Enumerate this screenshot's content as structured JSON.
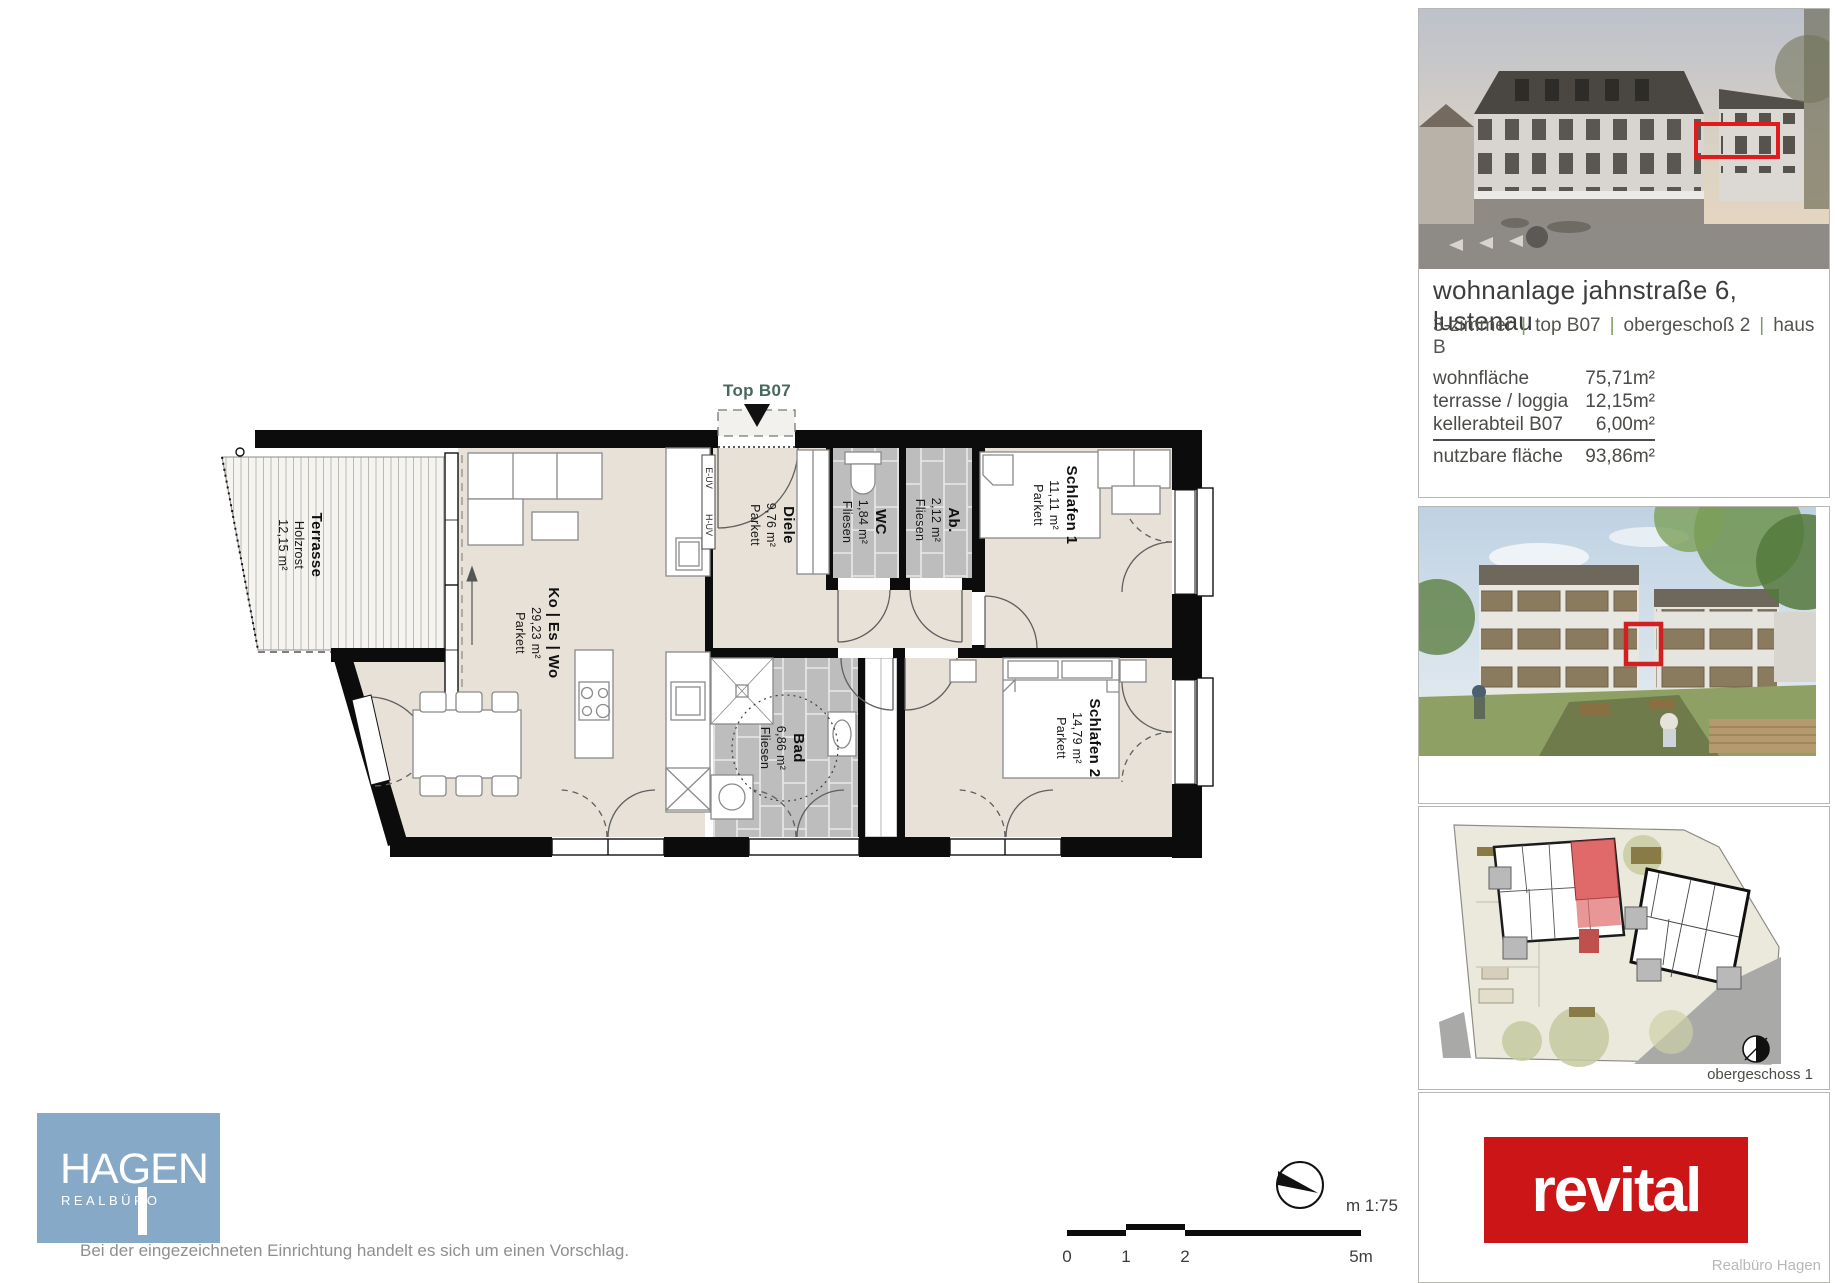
{
  "plan": {
    "top_label": "Top B07",
    "rooms": [
      {
        "id": "terrasse",
        "lines": [
          "Terrasse",
          "Holzrost",
          "12,15 m²"
        ]
      },
      {
        "id": "wohnen",
        "lines": [
          "Ko | Es | Wo",
          "29,23 m²",
          "Parkett"
        ]
      },
      {
        "id": "diele",
        "lines": [
          "Diele",
          "9,76 m²",
          "Parkett"
        ]
      },
      {
        "id": "wc",
        "lines": [
          "WC",
          "1,84 m²",
          "Fliesen"
        ]
      },
      {
        "id": "abstell",
        "lines": [
          "Ab.",
          "2,12 m²",
          "Fliesen"
        ]
      },
      {
        "id": "schlafen1",
        "lines": [
          "Schlafen 1",
          "11,11 m²",
          "Parkett"
        ]
      },
      {
        "id": "bad",
        "lines": [
          "Bad",
          "6,86 m²",
          "Fliesen"
        ]
      },
      {
        "id": "schlafen2",
        "lines": [
          "Schlafen 2",
          "14,79 m²",
          "Parkett"
        ]
      }
    ],
    "technical_labels": [
      "E-UV",
      "H-UV"
    ]
  },
  "scale": {
    "ticks": [
      "0",
      "1",
      "2",
      "5m"
    ],
    "ratio": "m 1:75"
  },
  "sidebar": {
    "title": "wohnanlage jahnstraße 6, lustenau",
    "separator": "|",
    "subtitle_parts": [
      "3-zimmer",
      "top B07",
      "obergeschoß 2",
      "haus B"
    ],
    "areas": [
      {
        "label": "wohnfläche",
        "value": "75,71m²"
      },
      {
        "label": "terrasse / loggia",
        "value": "12,15m²"
      },
      {
        "label": "kellerabteil B07",
        "value": "6,00m²"
      },
      {
        "label": "nutzbare fläche",
        "value": "93,86m²"
      }
    ],
    "siteplan_caption": "obergeschoss 1",
    "brand_logo": "revital",
    "credit": "Realbüro Hagen"
  },
  "footer": {
    "agency_name": "HAGEN",
    "agency_sub": "REALBÜRO",
    "disclaimer": "Bei der eingezeichneten Einrichtung handelt es sich um einen Vorschlag."
  },
  "colors": {
    "brand_red": "#cc1517",
    "highlight_red": "#e01b1d",
    "hagen_blue": "#86a9c7",
    "label_green": "#47685d",
    "pipe_green": "#7a9e5f",
    "floor_beige": "#e7e1d8",
    "tile_gray": "#bdbdbd"
  }
}
